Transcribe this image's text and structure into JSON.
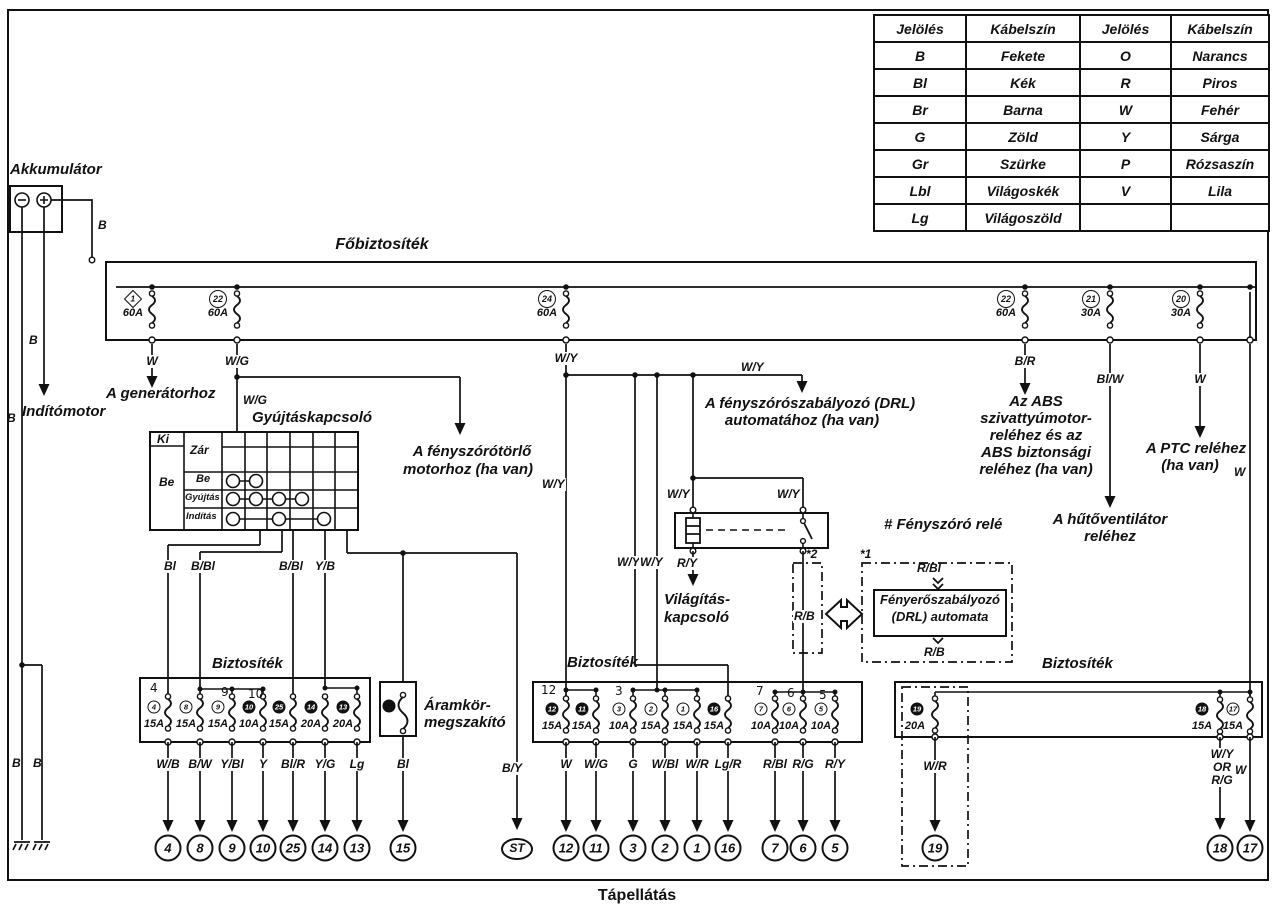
{
  "caption": "Tápellátás",
  "legend": {
    "headers": [
      "Jelölés",
      "Kábelszín",
      "Jelölés",
      "Kábelszín"
    ],
    "rows": [
      [
        "B",
        "Fekete",
        "O",
        "Narancs"
      ],
      [
        "Bl",
        "Kék",
        "R",
        "Piros"
      ],
      [
        "Br",
        "Barna",
        "W",
        "Fehér"
      ],
      [
        "G",
        "Zöld",
        "Y",
        "Sárga"
      ],
      [
        "Gr",
        "Szürke",
        "P",
        "Rózsaszín"
      ],
      [
        "Lbl",
        "Világoskék",
        "V",
        "Lila"
      ],
      [
        "Lg",
        "Világoszöld",
        "",
        ""
      ]
    ]
  },
  "battery": {
    "label": "Akkumulátor"
  },
  "starter": {
    "label": "Indítómotor"
  },
  "wires": {
    "b": "B",
    "w": "W",
    "wg": "W/G",
    "wy": "W/Y",
    "br": "B/R",
    "blw": "Bl/W",
    "ry": "R/Y",
    "rb": "R/B",
    "rbl": "R/Bl",
    "by": "B/Y",
    "bl": "Bl",
    "wr": "W/R",
    "or": "OR",
    "rg": "R/G"
  },
  "main_fuse_box": {
    "title": "Főbiztosíték",
    "fuses": [
      {
        "id": "1",
        "rating": "60A",
        "out": "W"
      },
      {
        "id": "22",
        "rating": "60A",
        "out": "W/G"
      },
      {
        "id": "24",
        "rating": "60A",
        "out": "W/Y"
      },
      {
        "id": "22",
        "rating": "60A",
        "out": "B/R"
      },
      {
        "id": "21",
        "rating": "30A",
        "out": "Bl/W"
      },
      {
        "id": "20",
        "rating": "30A",
        "out": "W"
      }
    ]
  },
  "destinations": {
    "generator": "A generátorhoz",
    "wiper_1": "A fényszórótörlő",
    "wiper_2": "motorhoz (ha van)",
    "drl_1": "A fényszórószabályozó (DRL)",
    "drl_2": "automatához (ha van)",
    "abs_1": "Az ABS",
    "abs_2": "szivattyúmotor-",
    "abs_3": "reléhez és az",
    "abs_4": "ABS biztonsági",
    "abs_5": "reléhez (ha van)",
    "fan_1": "A hűtőventilátor",
    "fan_2": "reléhez",
    "ptc_1": "A PTC reléhez",
    "ptc_2": "(ha van)",
    "light_switch_1": "Világítás-",
    "light_switch_2": "kapcsoló"
  },
  "ignition": {
    "title": "Gyújtáskapcsoló",
    "pos_off": "Ki",
    "pos_on": "Be",
    "rows": [
      "Zár",
      "Be",
      "Gyújtás",
      "Indítás"
    ],
    "outputs": [
      "Bl",
      "B/Bl",
      "B/Bl",
      "Y/B"
    ]
  },
  "relay": {
    "label": "# Fényszóró relé",
    "note_1": "*1",
    "note_2": "*2",
    "drl_unit_1": "Fényerőszabályozó",
    "drl_unit_2": "(DRL) automata"
  },
  "fuse_box_left": {
    "title": "Biztosíték",
    "notes": [
      "4",
      "9",
      "10"
    ],
    "fuses": [
      {
        "rating": "15A",
        "out": "W/B",
        "conn": "4"
      },
      {
        "rating": "15A",
        "out": "B/W",
        "conn": "8"
      },
      {
        "rating": "15A",
        "out": "Y/Bl",
        "conn": "9"
      },
      {
        "rating": "10A",
        "out": "Y",
        "conn": "10"
      },
      {
        "rating": "15A",
        "out": "Bl/R",
        "conn": "25"
      },
      {
        "rating": "20A",
        "out": "Y/G",
        "conn": "14"
      },
      {
        "rating": "20A",
        "out": "Lg",
        "conn": "13"
      }
    ]
  },
  "breaker": {
    "label_1": "Áramkör-",
    "label_2": "megszakító",
    "out": "Bl",
    "conn": "15"
  },
  "st_connector": "ST",
  "fuse_box_mid": {
    "title": "Biztosíték",
    "notes": [
      "12",
      "3",
      "7",
      "6",
      "5"
    ],
    "fuses": [
      {
        "rating": "15A",
        "out": "W",
        "conn": "12"
      },
      {
        "rating": "15A",
        "out": "W/G",
        "conn": "11"
      },
      {
        "rating": "10A",
        "out": "G",
        "conn": "3"
      },
      {
        "rating": "15A",
        "out": "W/Bl",
        "conn": "2"
      },
      {
        "rating": "15A",
        "out": "W/R",
        "conn": "1"
      },
      {
        "rating": "15A",
        "out": "Lg/R",
        "conn": "16"
      },
      {
        "rating": "10A",
        "out": "R/Bl",
        "conn": "7"
      },
      {
        "rating": "10A",
        "out": "R/G",
        "conn": "6"
      },
      {
        "rating": "10A",
        "out": "R/Y",
        "conn": "5"
      }
    ]
  },
  "fuse_box_right": {
    "title": "Biztosíték",
    "fuses": [
      {
        "rating": "20A",
        "out": "W/R",
        "conn": "19"
      },
      {
        "rating": "15A",
        "out_1": "W/Y",
        "out_2": "OR",
        "out_3": "R/G",
        "conn": "18"
      },
      {
        "rating": "15A",
        "out": "W",
        "conn": "17"
      }
    ]
  }
}
